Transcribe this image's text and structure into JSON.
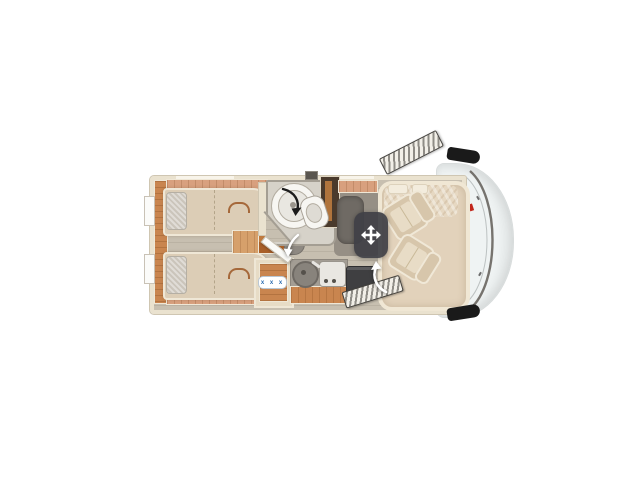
{
  "scene": {
    "type": "motorhome-floorplan-top-view",
    "rooms": {
      "rear": "twin-single-beds",
      "middle_top": "swivel-bathroom-with-shower-and-toilet",
      "middle_bottom": "kitchen-with-sink-and-hob",
      "front": "lounge-with-two-swivel-cab-seats"
    }
  },
  "kitchen": {
    "hob_symbols": "x x x"
  },
  "icons": {
    "move": "four-way-move-arrows",
    "shower_swivel": "curved-rotate-arrow-black",
    "bath_door_swing": "curved-door-arrow-white",
    "seat_swivel": "curved-rotate-arrow-white"
  },
  "colors": {
    "background": "#ffffff",
    "wall": "#eae2cf",
    "wall_edge": "#cfc6b2",
    "floor": "#c7bfb0",
    "floor_line": "#bab2a3",
    "wood": "#c9854f",
    "wood_dark": "#a95f28",
    "wood_light": "#d8a07e",
    "bed": "#dccdb6",
    "bed_edge": "#efe7d6",
    "pillow": "#cbc5bb",
    "seat": "#d7c6ab",
    "seat_cushion": "#e8dcc6",
    "platform": "#e2d2bb",
    "platform_edge": "#f0e7d4",
    "bench": "#6f6a64",
    "rug": "#968f85",
    "bathroom_floor": "#d6d2c9",
    "bathroom_wall": "#a49e93",
    "fixture_white": "#f7f6f2",
    "button": "#44434a",
    "button_icon": "#ffffff",
    "cab_body": "#eff3f3",
    "cab_line": "#57524c",
    "mirror": "#1a1a1a",
    "accent_red": "#c2271c",
    "hob_symbol_color": "#2b6cb0",
    "step_dark": "#3f3f41",
    "door_frame": "#44423e"
  }
}
